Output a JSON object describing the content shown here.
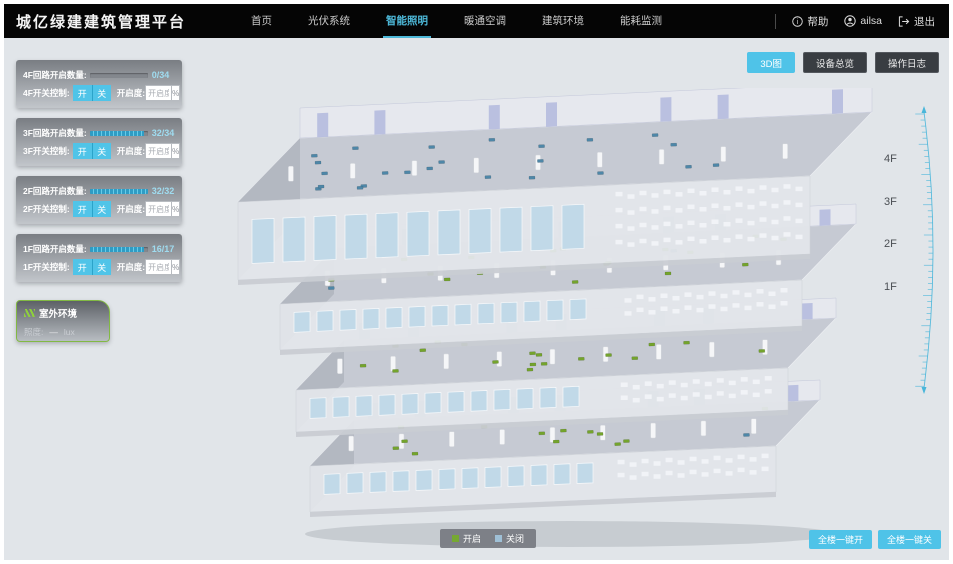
{
  "header": {
    "title": "城亿绿建建筑管理平台",
    "nav": [
      {
        "label": "首页",
        "active": false
      },
      {
        "label": "光伏系统",
        "active": false
      },
      {
        "label": "智能照明",
        "active": true
      },
      {
        "label": "暖通空调",
        "active": false
      },
      {
        "label": "建筑环境",
        "active": false
      },
      {
        "label": "能耗监测",
        "active": false
      }
    ],
    "help_label": "帮助",
    "user_name": "ailsa",
    "logout_label": "退出"
  },
  "controls": {
    "on_label": "开",
    "off_label": "关",
    "openness_label": "开启度:",
    "openness_placeholder": "开启度",
    "percent_suffix": "%"
  },
  "floors": [
    {
      "id": "4F",
      "loop_label": "4F回路开启数量:",
      "switch_label": "4F开关控制:",
      "value": "0/34",
      "open": 0,
      "total": 34,
      "ratio_pct": 0
    },
    {
      "id": "3F",
      "loop_label": "3F回路开启数量:",
      "switch_label": "3F开关控制:",
      "value": "32/34",
      "open": 32,
      "total": 34,
      "ratio_pct": 94
    },
    {
      "id": "2F",
      "loop_label": "2F回路开启数量:",
      "switch_label": "2F开关控制:",
      "value": "32/32",
      "open": 32,
      "total": 32,
      "ratio_pct": 100
    },
    {
      "id": "1F",
      "loop_label": "1F回路开启数量:",
      "switch_label": "1F开关控制:",
      "value": "16/17",
      "open": 16,
      "total": 17,
      "ratio_pct": 94
    }
  ],
  "outdoor": {
    "title": "室外环境",
    "illuminance_label": "照度:",
    "illuminance_value": "—",
    "illuminance_unit": "lux"
  },
  "view_buttons": [
    {
      "label": "3D图",
      "active": true
    },
    {
      "label": "设备总览",
      "active": false
    },
    {
      "label": "操作日志",
      "active": false
    }
  ],
  "scene": {
    "floor_labels": [
      "4F",
      "3F",
      "2F",
      "1F"
    ]
  },
  "legend": {
    "on_label": "开启",
    "off_label": "关闭",
    "on_color": "#76a832",
    "off_color": "#9fc0d6"
  },
  "bulk_buttons": [
    {
      "label": "全楼一键开"
    },
    {
      "label": "全楼一键关"
    }
  ],
  "colors": {
    "accent": "#4fc3e8",
    "navbar": "#050505",
    "background": "#e1e5e9"
  },
  "model": {
    "on_color": "#74a42c",
    "off_color": "#4e87a8",
    "floors": [
      {
        "label": "4F",
        "on": 0,
        "off": 24
      },
      {
        "label": "3F",
        "on": 20,
        "off": 2
      },
      {
        "label": "2F",
        "on": 18,
        "off": 0
      },
      {
        "label": "1F",
        "on": 13,
        "off": 1
      }
    ]
  }
}
